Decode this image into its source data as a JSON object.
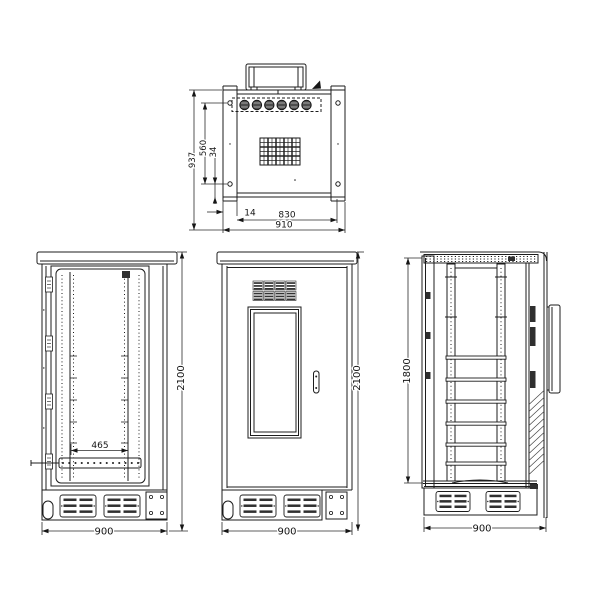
{
  "drawing": {
    "background": "#ffffff",
    "line_color": "#1c1c1c",
    "views": {
      "top": {
        "dims": {
          "depth_overall": "937",
          "depth_inner": "560",
          "rear_offset": "34",
          "side_flange": "14",
          "width_inner": "830",
          "width_overall": "910"
        }
      },
      "front_open": {
        "dims": {
          "height": "2100",
          "rail_spacing": "465",
          "width": "900"
        }
      },
      "front_closed": {
        "dims": {
          "height": "2100",
          "width": "900"
        }
      },
      "side": {
        "dims": {
          "frame_height": "1800",
          "width": "900"
        }
      }
    }
  }
}
